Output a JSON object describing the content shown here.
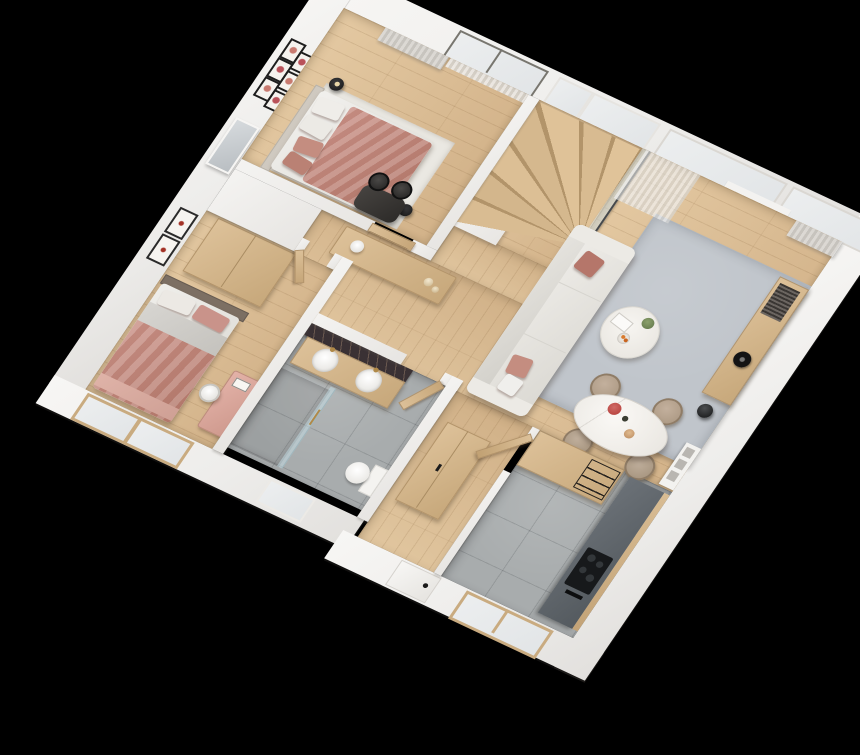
{
  "scene": {
    "title": "3D rendered apartment floor plan, top-down axonometric view",
    "background_color": "#000000",
    "style": "photorealistic dollhouse render, white walls, oak floors, blush accents"
  },
  "palette": {
    "wall_white": "#f2f1ee",
    "oak_floor": "#dcbf98",
    "oak_furniture": "#d2b289",
    "gray_tile": "#a8acad",
    "rug_gray": "#c0c5cb",
    "sofa_white": "#eceae6",
    "blush_pink": "#c48d80",
    "rust_pillow": "#b5766a",
    "charcoal_counter": "#60666c",
    "cooktop_black": "#17191b",
    "marble_dark": "#3a3134",
    "brass": "#b08948",
    "glass_blue": "#cfe0e6"
  },
  "rooms": {
    "master_bedroom": {
      "label": "Master bedroom",
      "floor": "oak plank",
      "items": [
        "double bed with blush duvet and pillows",
        "gallery wall of six framed prints",
        "leaning mirror",
        "black desk with two black chairs",
        "round black side tables",
        "gray curtains",
        "glazed balcony door",
        "white area rug"
      ]
    },
    "staircase": {
      "label": "Winder staircase",
      "items": [
        "oak winder treads",
        "curved white wall",
        "glass balustrade with dark handrail",
        "two windows"
      ]
    },
    "living_room": {
      "label": "Living / dining room",
      "items": [
        "white fabric sofa with blush pillows",
        "gray area rug",
        "round marble coffee table with terracotta base",
        "plant, books and fruit bowl on table",
        "oak media console with vinyl records and record player",
        "black sphere speaker",
        "wall radiator with three slots",
        "oval marble dining table",
        "four taupe dining chairs",
        "flowers and bottle on dining table",
        "sheer and gray curtains",
        "full-height windows"
      ]
    },
    "hallway": {
      "label": "Hallway",
      "floor": "oak plank",
      "items": [
        "oak sideboard",
        "white cylinder lamp",
        "glass decor spheres"
      ]
    },
    "second_bedroom": {
      "label": "Second bedroom",
      "floor": "oak plank",
      "items": [
        "bed with blush blanket and gray sheets",
        "dark headboard",
        "oak wardrobe",
        "pink vanity desk with white chair",
        "two framed bird prints",
        "two wood-framed windows"
      ]
    },
    "bathroom": {
      "label": "Bathroom",
      "floor": "gray stone tile",
      "items": [
        "dark marble vanity wall",
        "oak vanity with two round white basins",
        "brass faucets",
        "walk-in shower with glass screen and brass towel bar",
        "toilet",
        "window",
        "oak door"
      ]
    },
    "entrance_hall": {
      "label": "Entrance hall",
      "floor": "oak plank",
      "items": [
        "oak closet",
        "white entrance door with black handle",
        "open oak door to kitchen"
      ]
    },
    "kitchen": {
      "label": "Kitchen",
      "floor": "gray stone tile",
      "items": [
        "oak peninsula cabinet with black wire shelf",
        "charcoal worktop along wall",
        "black cooktop",
        "oak ledge strip",
        "wood-framed window"
      ]
    }
  }
}
